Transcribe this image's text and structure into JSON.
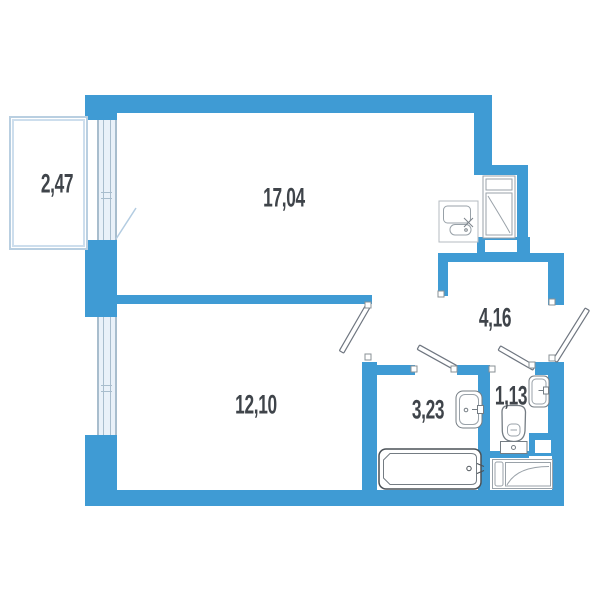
{
  "title": "apartment-floor-plan",
  "rooms": [
    {
      "name": "balcony",
      "area": "2,47"
    },
    {
      "name": "living-room",
      "area": "17,04"
    },
    {
      "name": "bedroom",
      "area": "12,10"
    },
    {
      "name": "hallway",
      "area": "4,16"
    },
    {
      "name": "bathroom",
      "area": "3,23"
    },
    {
      "name": "wc",
      "area": "1,13"
    }
  ],
  "colors": {
    "wall": "#3F9BD4",
    "window_fill": "#E9F1F9",
    "window_frame": "#A8BDCD",
    "balcony_outline": "#B9CFE1",
    "fixture_outline": "#747C83",
    "appliance_outline": "#9AA2A9",
    "text": "#3F444A"
  },
  "fixtures": [
    "kitchen-sink-counter",
    "refrigerator",
    "bathtub",
    "washbasin",
    "toilet",
    "corner-sink",
    "washing-machine",
    "vent-duct"
  ]
}
